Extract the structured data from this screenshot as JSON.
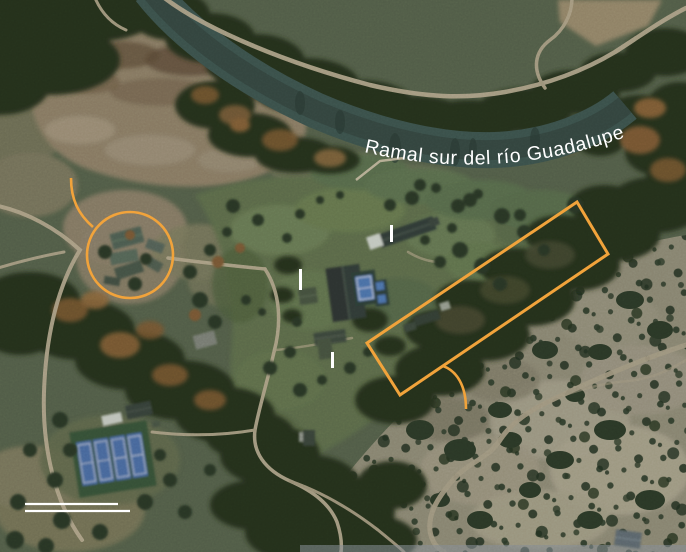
{
  "map": {
    "river_label": "Ramal sur del río Guadalupe",
    "colors": {
      "annotation": "#F1A33B",
      "label_text": "#FFFFFF",
      "tick": "#FFFFFF",
      "scalebar": "#FFFFFF"
    },
    "annotations": {
      "camp_circle": {
        "cx": 130,
        "cy": 255,
        "r": 43
      },
      "circle_leader": {
        "path": "M 71,178 C 71,199 78,214 93,227"
      },
      "flood_rect": {
        "points": "367,343 577,202 608,254 400,395"
      },
      "rect_leader": {
        "path": "M 443,366 C 457,371 466,386 466,409"
      },
      "building_ticks": [
        {
          "x": 390,
          "y": 225,
          "h": 17
        },
        {
          "x": 299,
          "y": 269,
          "h": 21
        },
        {
          "x": 331,
          "y": 352,
          "h": 16
        }
      ],
      "scale_bars": [
        {
          "x1": 25,
          "y1": 504,
          "x2": 118,
          "y2": 504
        },
        {
          "x1": 25,
          "y1": 511,
          "x2": 130,
          "y2": 511
        }
      ]
    }
  }
}
